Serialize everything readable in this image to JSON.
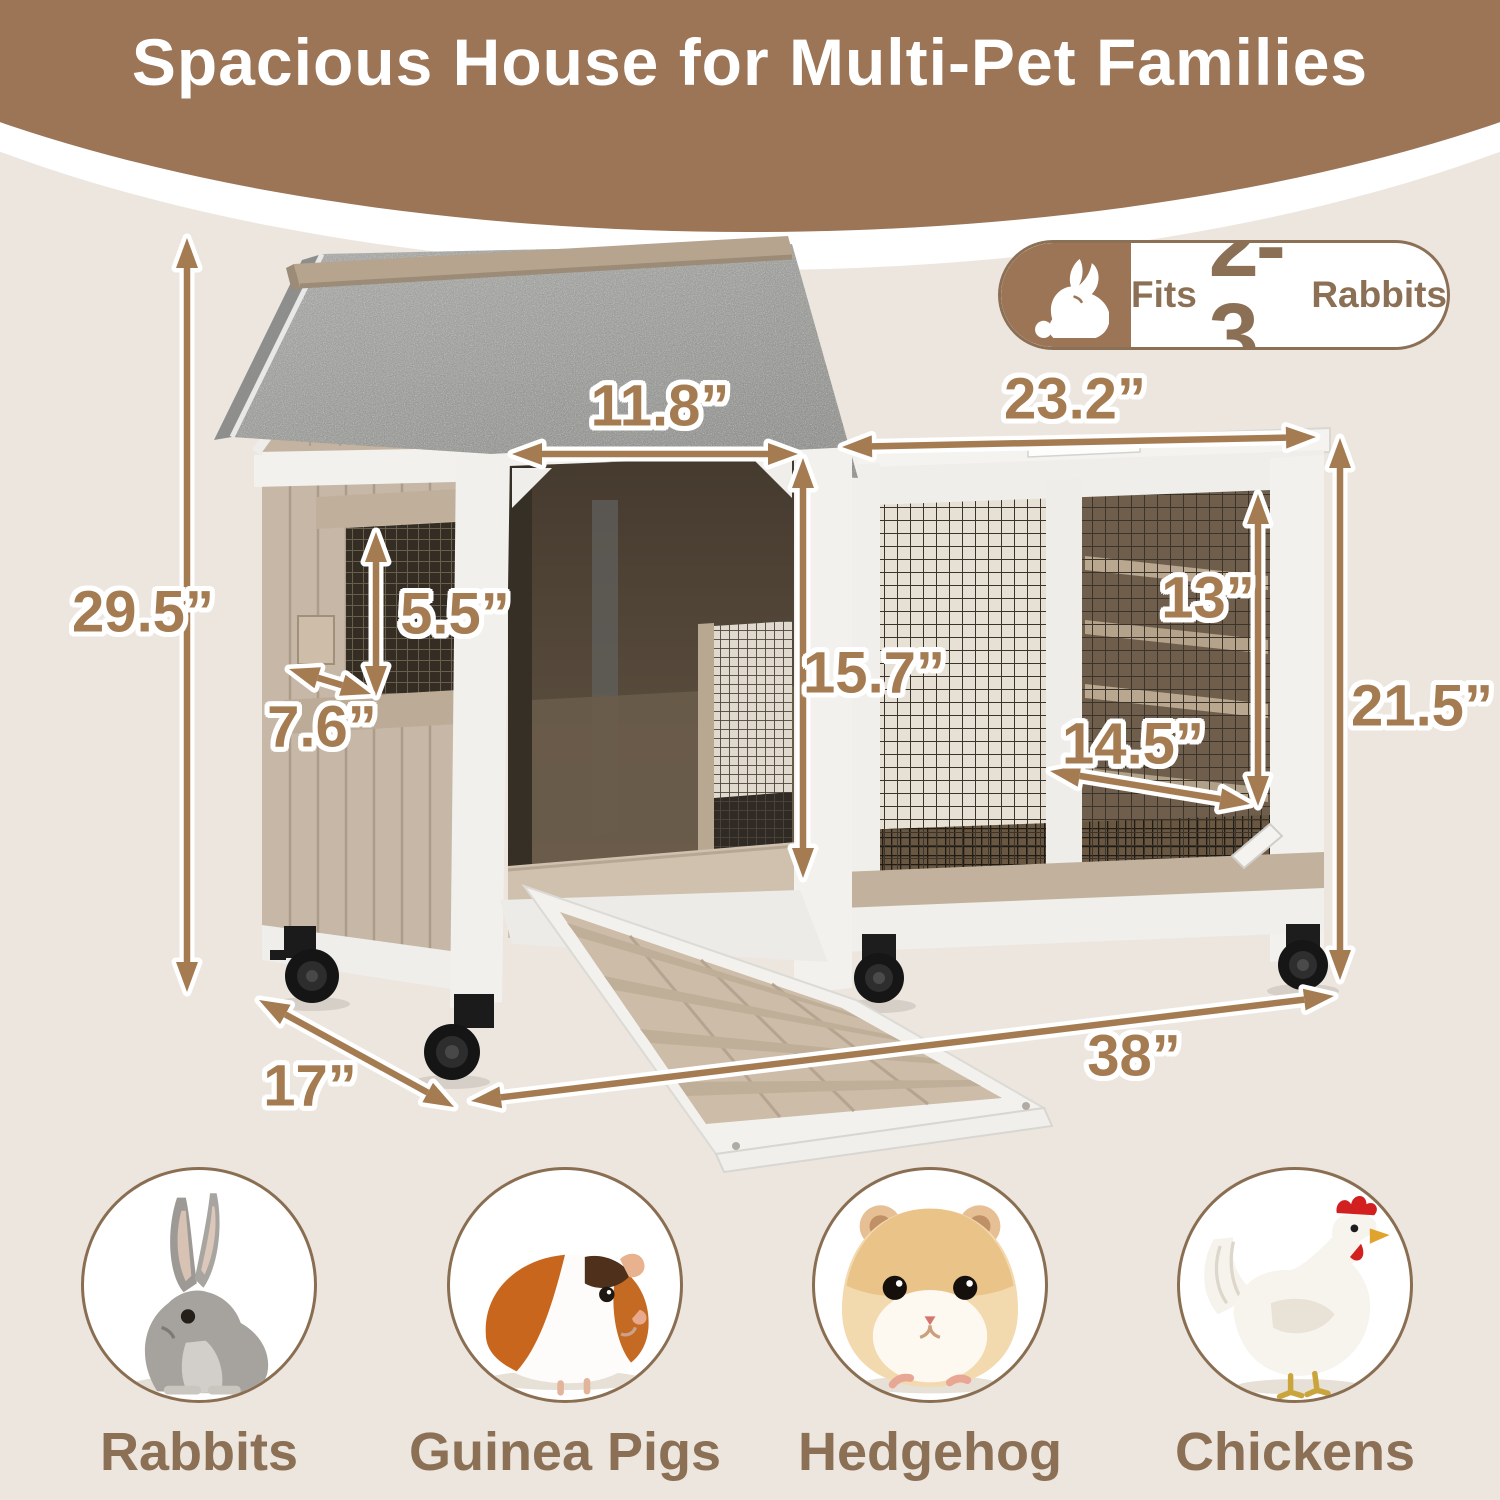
{
  "title": "Spacious House for Multi-Pet Families",
  "badge": {
    "icon": "rabbit-icon",
    "fits_label": "Fits",
    "count": "2-3",
    "animal": "Rabbits"
  },
  "dimensions": {
    "overall_height": "29.5”",
    "door_width": "11.8”",
    "run_top_width": "23.2”",
    "window_height": "5.5”",
    "window_width": "7.6”",
    "door_height": "15.7”",
    "run_interior_height": "13”",
    "run_door_width": "14.5”",
    "run_height": "21.5”",
    "depth": "17”",
    "overall_width": "38”"
  },
  "pets": [
    {
      "label": "Rabbits",
      "icon": "rabbit-photo"
    },
    {
      "label": "Guinea Pigs",
      "icon": "guinea-pig-photo"
    },
    {
      "label": "Hedgehog",
      "icon": "hamster-photo"
    },
    {
      "label": "Chickens",
      "icon": "chicken-photo"
    }
  ],
  "colors": {
    "banner_brown": "#9c7456",
    "accent_brown": "#a57c52",
    "label_brown": "#8c7055",
    "background": "#ece6df"
  }
}
